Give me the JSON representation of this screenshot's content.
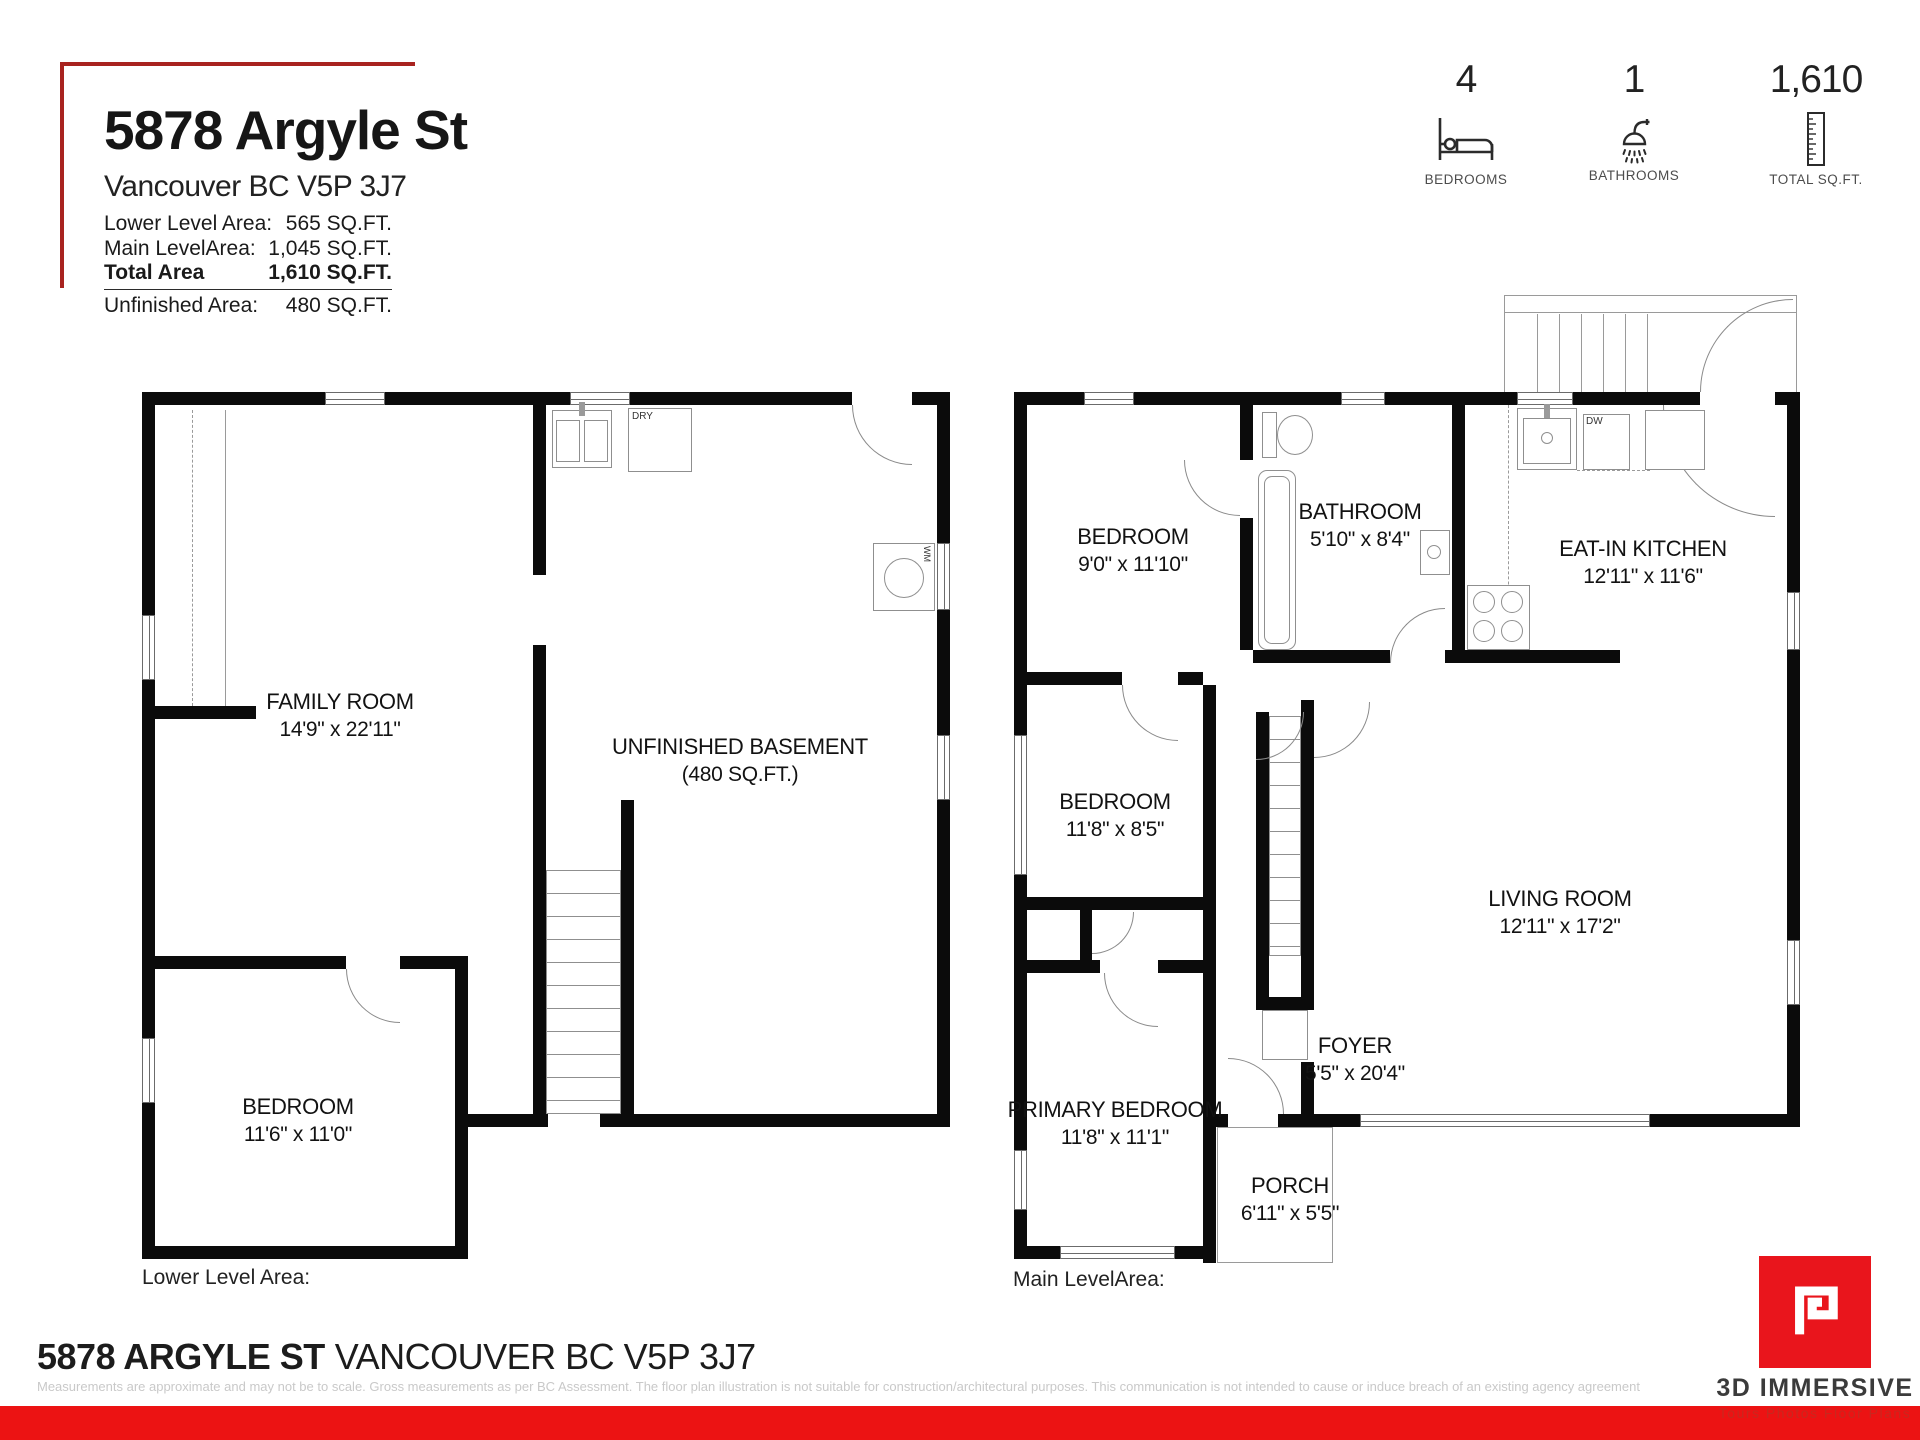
{
  "header": {
    "title": "5878 Argyle St",
    "subtitle": "Vancouver BC V5P 3J7",
    "area_rows": [
      {
        "label": "Lower Level Area:",
        "value": "565 SQ.FT."
      },
      {
        "label": "Main LevelArea:",
        "value": "1,045 SQ.FT."
      },
      {
        "label": "Total Area",
        "value": "1,610 SQ.FT."
      }
    ],
    "unfinished_row": {
      "label": "Unfinished Area:",
      "value": "480 SQ.FT."
    },
    "stats": [
      {
        "value": "4",
        "label": "BEDROOMS"
      },
      {
        "value": "1",
        "label": "BATHROOMS"
      },
      {
        "value": "1,610",
        "label": "TOTAL SQ.FT."
      }
    ]
  },
  "lower_plan": {
    "caption": "Lower Level Area:",
    "rooms": {
      "family_room": {
        "name": "FAMILY ROOM",
        "dims": "14'9\" x 22'11\""
      },
      "unfinished_basement": {
        "name": "UNFINISHED BASEMENT",
        "dims": "(480 SQ.FT.)"
      },
      "bedroom": {
        "name": "BEDROOM",
        "dims": "11'6\" x 11'0\""
      }
    },
    "labels": {
      "dryer": "DRY",
      "washer": "WM"
    }
  },
  "main_plan": {
    "caption": "Main LevelArea:",
    "rooms": {
      "bedroom_front": {
        "name": "BEDROOM",
        "dims": "9'0\" x 11'10\""
      },
      "bathroom": {
        "name": "BATHROOM",
        "dims": "5'10\" x 8'4\""
      },
      "kitchen": {
        "name": "EAT-IN KITCHEN",
        "dims": "12'11\" x 11'6\""
      },
      "bedroom_mid": {
        "name": "BEDROOM",
        "dims": "11'8\" x 8'5\""
      },
      "living_room": {
        "name": "LIVING ROOM",
        "dims": "12'11\" x 17'2\""
      },
      "foyer": {
        "name": "FOYER",
        "dims": "5'5\" x 20'4\""
      },
      "primary_bedroom": {
        "name": "PRIMARY BEDROOM",
        "dims": "11'8\" x 11'1\""
      },
      "porch": {
        "name": "PORCH",
        "dims": "6'11\" x 5'5\""
      }
    },
    "labels": {
      "dishwasher": "DW"
    }
  },
  "footer": {
    "address_bold": "5878 ARGYLE ST",
    "address_rest": "VANCOUVER BC V5P 3J7",
    "disclaimer": "Measurements are approximate and may not be to scale. Gross measurements as per BC Assessment. The floor plan illustration is not suitable for construction/architectural purposes. This communication is not intended to cause or induce breach of an existing agency agreement",
    "logo": {
      "brand": "3D IMMERSIVE",
      "tagline": "Tours   Photos   Floor Plans"
    }
  }
}
